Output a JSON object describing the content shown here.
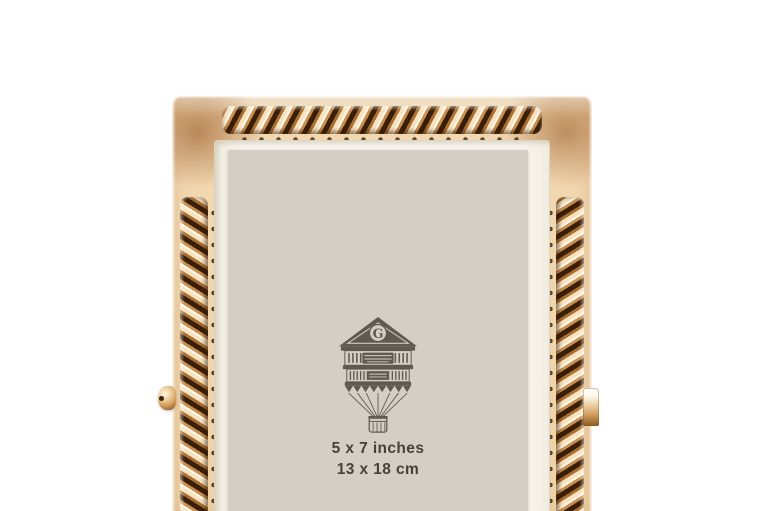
{
  "photo": {
    "description": "Rose gold rope-edge picture frame with easel stand, front view on white seamless background, bottom cropped",
    "background_color": "#ffffff",
    "frame": {
      "finish": "polished rose gold with twisted rope border",
      "colors": {
        "highlight": "#fdf5e4",
        "light_gold": "#f1d6ae",
        "mid_copper": "#d5a368",
        "deep_copper": "#a86c31",
        "shadow": "#3a1f08"
      }
    },
    "mat_color": "#f4f0e6",
    "insert_card": {
      "background_color": "#d3cfc4",
      "text_color": "#46423a",
      "logo_letter": "G",
      "size_line_inches": "5 x 7 inches",
      "size_line_cm": "13 x 18 cm"
    }
  }
}
